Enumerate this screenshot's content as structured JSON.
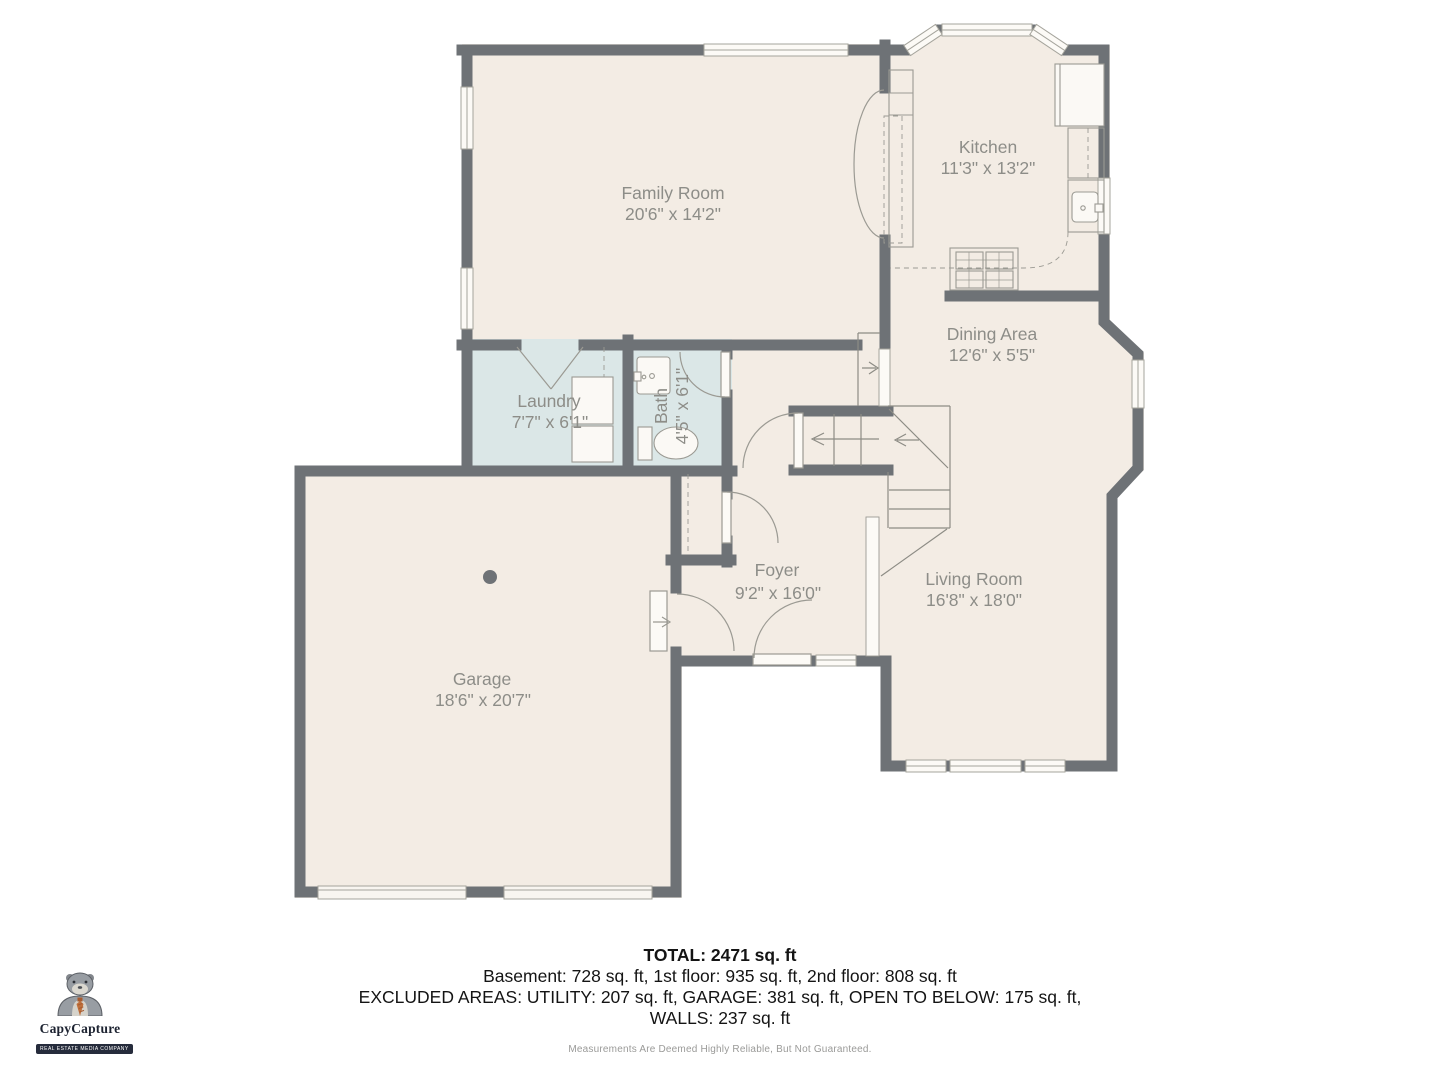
{
  "plan": {
    "title": "First floor plan",
    "rooms": [
      {
        "name": "Family Room",
        "dims": "20'6\" x 14'2\""
      },
      {
        "name": "Kitchen",
        "dims": "11'3\" x 13'2\""
      },
      {
        "name": "Dining Area",
        "dims": "12'6\" x 5'5\""
      },
      {
        "name": "Laundry",
        "dims": "7'7\" x 6'1\""
      },
      {
        "name": "Bath",
        "dims": "4'5\" x 6'1\""
      },
      {
        "name": "Foyer",
        "dims": "9'2\" x 16'0\""
      },
      {
        "name": "Living Room",
        "dims": "16'8\" x 18'0\""
      },
      {
        "name": "Garage",
        "dims": "18'6\" x 20'7\""
      }
    ]
  },
  "summary": {
    "total": "TOTAL: 2471 sq. ft",
    "floors": "Basement: 728 sq. ft, 1st floor: 935 sq. ft, 2nd floor: 808 sq. ft",
    "excluded": "EXCLUDED AREAS: UTILITY: 207 sq. ft, GARAGE: 381 sq. ft, OPEN TO BELOW: 175 sq. ft,",
    "walls": "WALLS: 237 sq. ft"
  },
  "branding": {
    "company": "CapyCapture",
    "tagline": "REAL ESTATE MEDIA COMPANY"
  },
  "disclaimer": "Measurements Are Deemed Highly Reliable, But Not Guaranteed.",
  "colors": {
    "wall": "#6e7276",
    "floor": "#f3ece4",
    "wet_floor": "#dbe7e7",
    "fixture_line": "#9b9a93",
    "label": "#8d8d88",
    "tie_accent": "#c0703c"
  }
}
